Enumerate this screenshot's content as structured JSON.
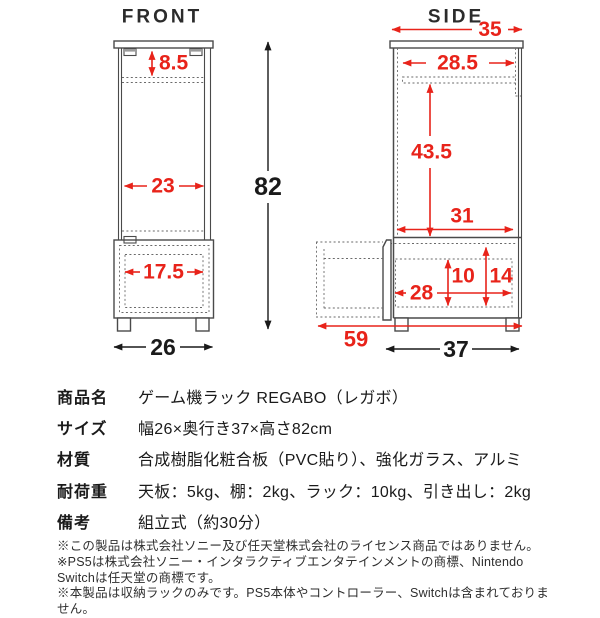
{
  "front": {
    "title": "FRONT",
    "dim_top_gap": "8.5",
    "dim_inner_width": "23",
    "dim_drawer_inner_width": "17.5",
    "dim_width": "26",
    "dim_height": "82"
  },
  "side": {
    "title": "SIDE",
    "dim_top_depth": "35",
    "dim_inner_depth": "28.5",
    "dim_upper_inner_height": "43.5",
    "dim_shelf_depth": "31",
    "dim_drawer_inner_height": "10",
    "dim_drawer_section_height": "14",
    "dim_drawer_inner_depth": "28",
    "dim_extended_depth": "59",
    "dim_depth": "37"
  },
  "colors": {
    "dimension_red": "#e8231a",
    "dimension_black": "#1a1a1a",
    "outline_gray": "#4a4a4a"
  },
  "spec_table": {
    "rows": [
      {
        "label": "商品名",
        "value": "ゲーム機ラック REGABO（レガボ）"
      },
      {
        "label": "サイズ",
        "value": "幅26×奥行き37×高さ82cm"
      },
      {
        "label": "材質",
        "value": "合成樹脂化粧合板（PVC貼り）、強化ガラス、アルミ"
      },
      {
        "label": "耐荷重",
        "value": "天板：5kg、棚：2kg、ラック：10kg、引き出し：2kg"
      },
      {
        "label": "備考",
        "value": "組立式（約30分）"
      }
    ]
  },
  "footnotes": [
    "※この製品は株式会社ソニー及び任天堂株式会社のライセンス商品ではありません。",
    "※PS5は株式会社ソニー・インタラクティブエンタテインメントの商標、Nintendo Switchは任天堂の商標です。",
    "※本製品は収納ラックのみです。PS5本体やコントローラー、Switchは含まれておりません。"
  ]
}
